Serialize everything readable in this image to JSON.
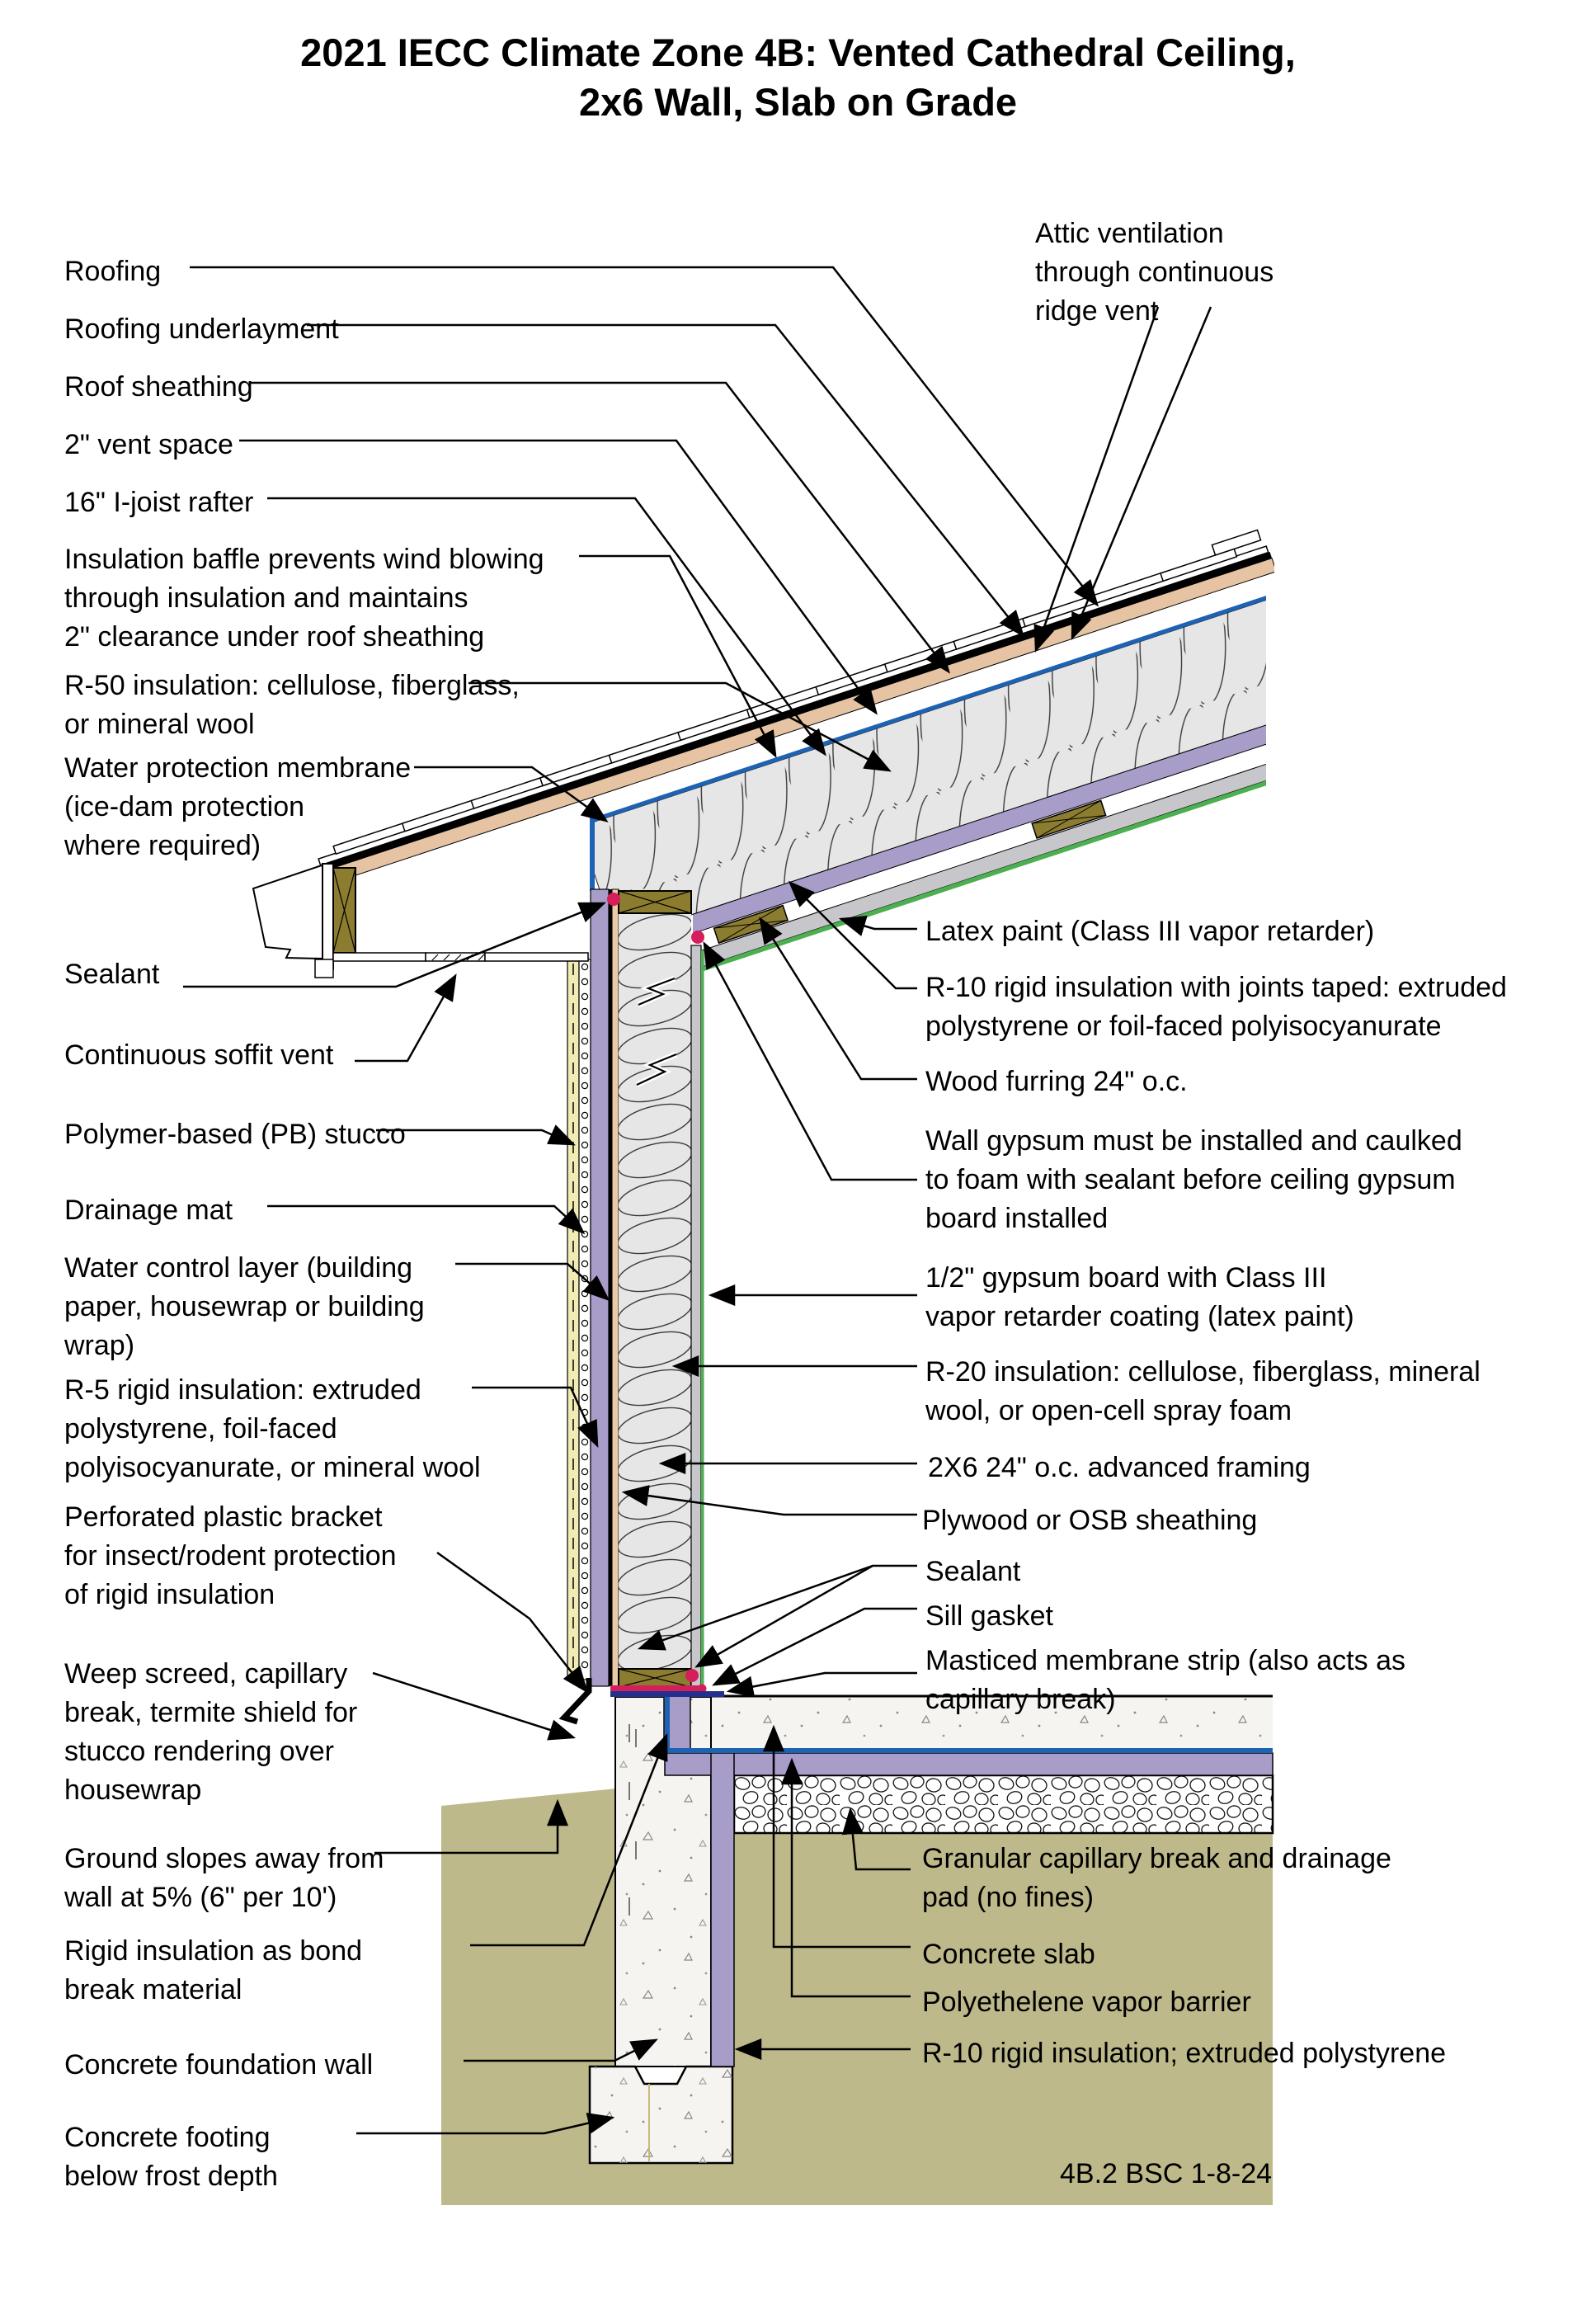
{
  "title": "2021 IECC Climate Zone 4B: Vented Cathedral Ceiling,\n2x6 Wall, Slab on Grade",
  "footer_code": "4B.2 BSC 1-8-24",
  "colors": {
    "rigid_insulation_purple": "#a89cc9",
    "wood_olive": "#8c7c30",
    "sheathing_tan": "#e6c4a3",
    "stucco_yellow": "#f2ecb4",
    "soil_olive": "#bdb98a",
    "baffle_blue": "#1e62b4",
    "sill_gasket_navy": "#25308e",
    "sealant_crimson": "#d41f5a",
    "latex_paint_green": "#4caf50",
    "gypsum_gray": "#c7c7cb",
    "batt_insulation_gray": "#e6e6e6",
    "concrete_white": "#f5f4f0"
  },
  "labels_left": {
    "roofing": "Roofing",
    "roofing_underlayment": "Roofing underlayment",
    "roof_sheathing": "Roof sheathing",
    "vent_space": "2\" vent space",
    "ijoist_rafter": "16\" I-joist rafter",
    "insulation_baffle": "Insulation baffle prevents wind blowing\nthrough insulation and maintains\n2\" clearance under roof sheathing",
    "r50": "R-50 insulation: cellulose, fiberglass,\nor mineral wool",
    "water_membrane": "Water protection membrane\n(ice-dam protection\nwhere required)",
    "sealant": "Sealant",
    "soffit_vent": "Continuous soffit vent",
    "stucco": "Polymer-based (PB) stucco",
    "drainage_mat": "Drainage mat",
    "water_control": "Water control layer (building\npaper, housewrap or building\nwrap)",
    "r5": "R-5 rigid insulation: extruded\npolystyrene, foil-faced\npolyisocyanurate, or mineral wool",
    "perforated": "Perforated plastic bracket\nfor insect/rodent protection\nof rigid insulation",
    "weep_screed": "Weep screed, capillary\nbreak, termite shield for\nstucco rendering over\nhousewrap",
    "ground_slopes": "Ground slopes away from\nwall at 5% (6\" per 10')",
    "rigid_bond_break": "Rigid insulation as bond\nbreak material",
    "foundation_wall": "Concrete foundation wall",
    "footing": "Concrete footing\nbelow frost depth"
  },
  "labels_right": {
    "attic_vent": "Attic ventilation\nthrough continuous\nridge vent",
    "latex_paint": "Latex paint (Class III vapor retarder)",
    "r10_ceiling": "R-10 rigid insulation with joints taped: extruded\npolystyrene or foil-faced polyisocyanurate",
    "wood_furring": "Wood furring 24\" o.c.",
    "wall_gypsum_note": "Wall gypsum must be installed and caulked\nto foam with sealant before ceiling gypsum\nboard installed",
    "half_gypsum": "1/2\" gypsum board with Class III\nvapor retarder coating (latex paint)",
    "r20": "R-20 insulation: cellulose, fiberglass, mineral\nwool, or open-cell spray foam",
    "framing_2x6": "2X6 24\" o.c. advanced framing",
    "plywood": "Plywood or OSB sheathing",
    "sealant_base": "Sealant",
    "sill_gasket": "Sill gasket",
    "masticed": "Masticed membrane strip (also acts as\ncapillary break)",
    "granular": "Granular capillary break and drainage\npad (no fines)",
    "concrete_slab": "Concrete slab",
    "poly_vapor_barrier": "Polyethelene vapor barrier",
    "r10_slab": "R-10 rigid insulation; extruded polystyrene"
  }
}
